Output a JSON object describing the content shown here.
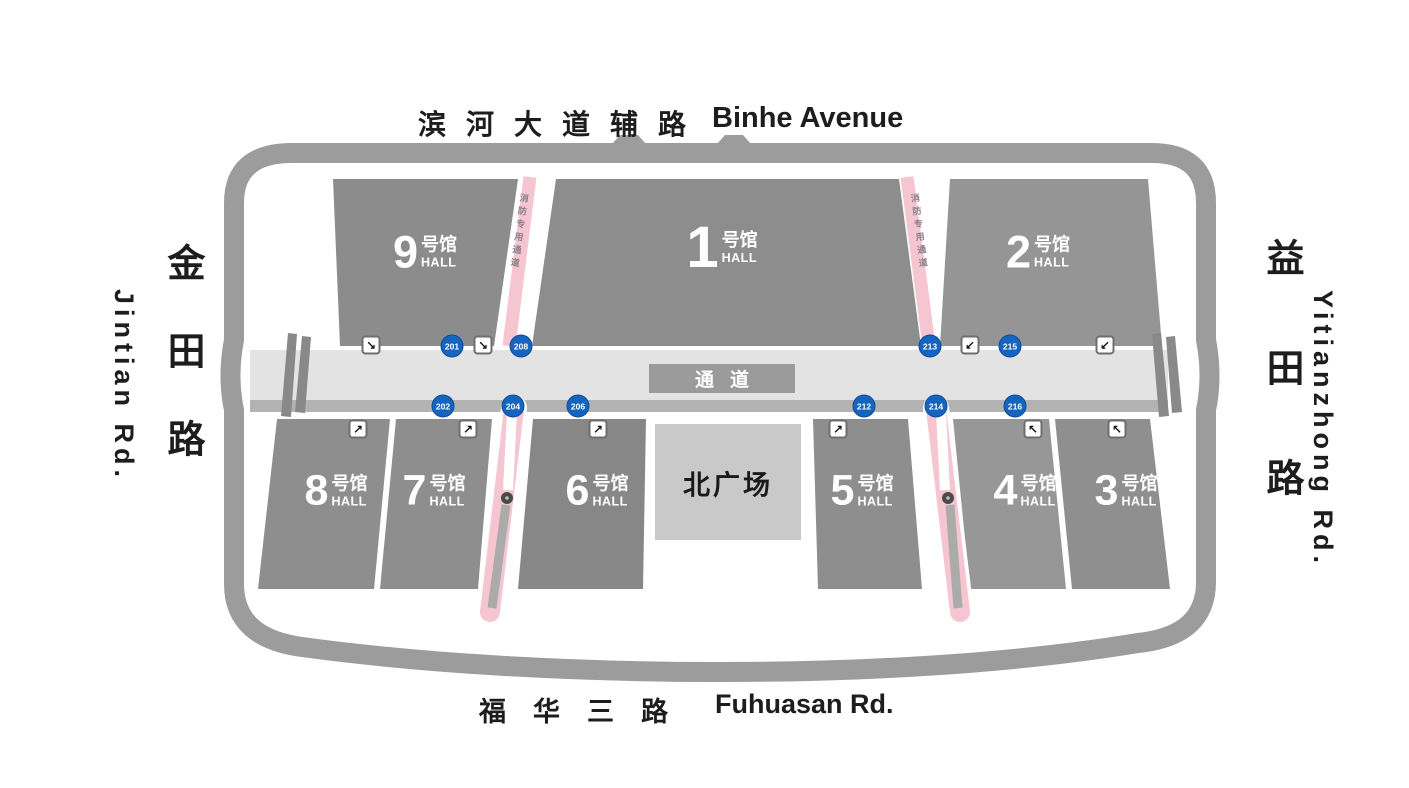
{
  "roads": {
    "top": {
      "zh": "滨河大道辅路",
      "en": "Binhe Avenue"
    },
    "bottom": {
      "zh": "福华三路",
      "en": "Fuhuasan Rd."
    },
    "left": {
      "zh": "金田路",
      "en": "Jintian Rd."
    },
    "right": {
      "zh": "益田路",
      "en": "Yitianzhong Rd."
    }
  },
  "halls": {
    "h1": {
      "number": "1",
      "suffix": "号馆",
      "hall": "HALL"
    },
    "h2": {
      "number": "2",
      "suffix": "号馆",
      "hall": "HALL"
    },
    "h3": {
      "number": "3",
      "suffix": "号馆",
      "hall": "HALL"
    },
    "h4": {
      "number": "4",
      "suffix": "号馆",
      "hall": "HALL"
    },
    "h5": {
      "number": "5",
      "suffix": "号馆",
      "hall": "HALL"
    },
    "h6": {
      "number": "6",
      "suffix": "号馆",
      "hall": "HALL"
    },
    "h7": {
      "number": "7",
      "suffix": "号馆",
      "hall": "HALL"
    },
    "h8": {
      "number": "8",
      "suffix": "号馆",
      "hall": "HALL"
    },
    "h9": {
      "number": "9",
      "suffix": "号馆",
      "hall": "HALL"
    }
  },
  "plaza": {
    "label": "北广场"
  },
  "corridor": {
    "label": "通道"
  },
  "fire_lane": {
    "label": "消防专用通道"
  },
  "gates": {
    "north": [
      "201",
      "208",
      "213",
      "215"
    ],
    "south": [
      "202",
      "204",
      "206",
      "212",
      "214",
      "216"
    ]
  },
  "escalators": {
    "se": "↘",
    "sw": "↙",
    "ne": "↗",
    "nw": "↖"
  },
  "colors": {
    "hall_fill": "#8d8d8d",
    "ring_road": "#9c9c9c",
    "corridor_fill": "#e3e3e3",
    "corridor_shadow": "#b3b3b3",
    "plaza_fill": "#c9c9c9",
    "fire_lane_pink": "#f6c5d2",
    "gate_badge_blue": "#1565c0",
    "hall_text": "#ffffff",
    "road_text": "#1d1d1d"
  }
}
